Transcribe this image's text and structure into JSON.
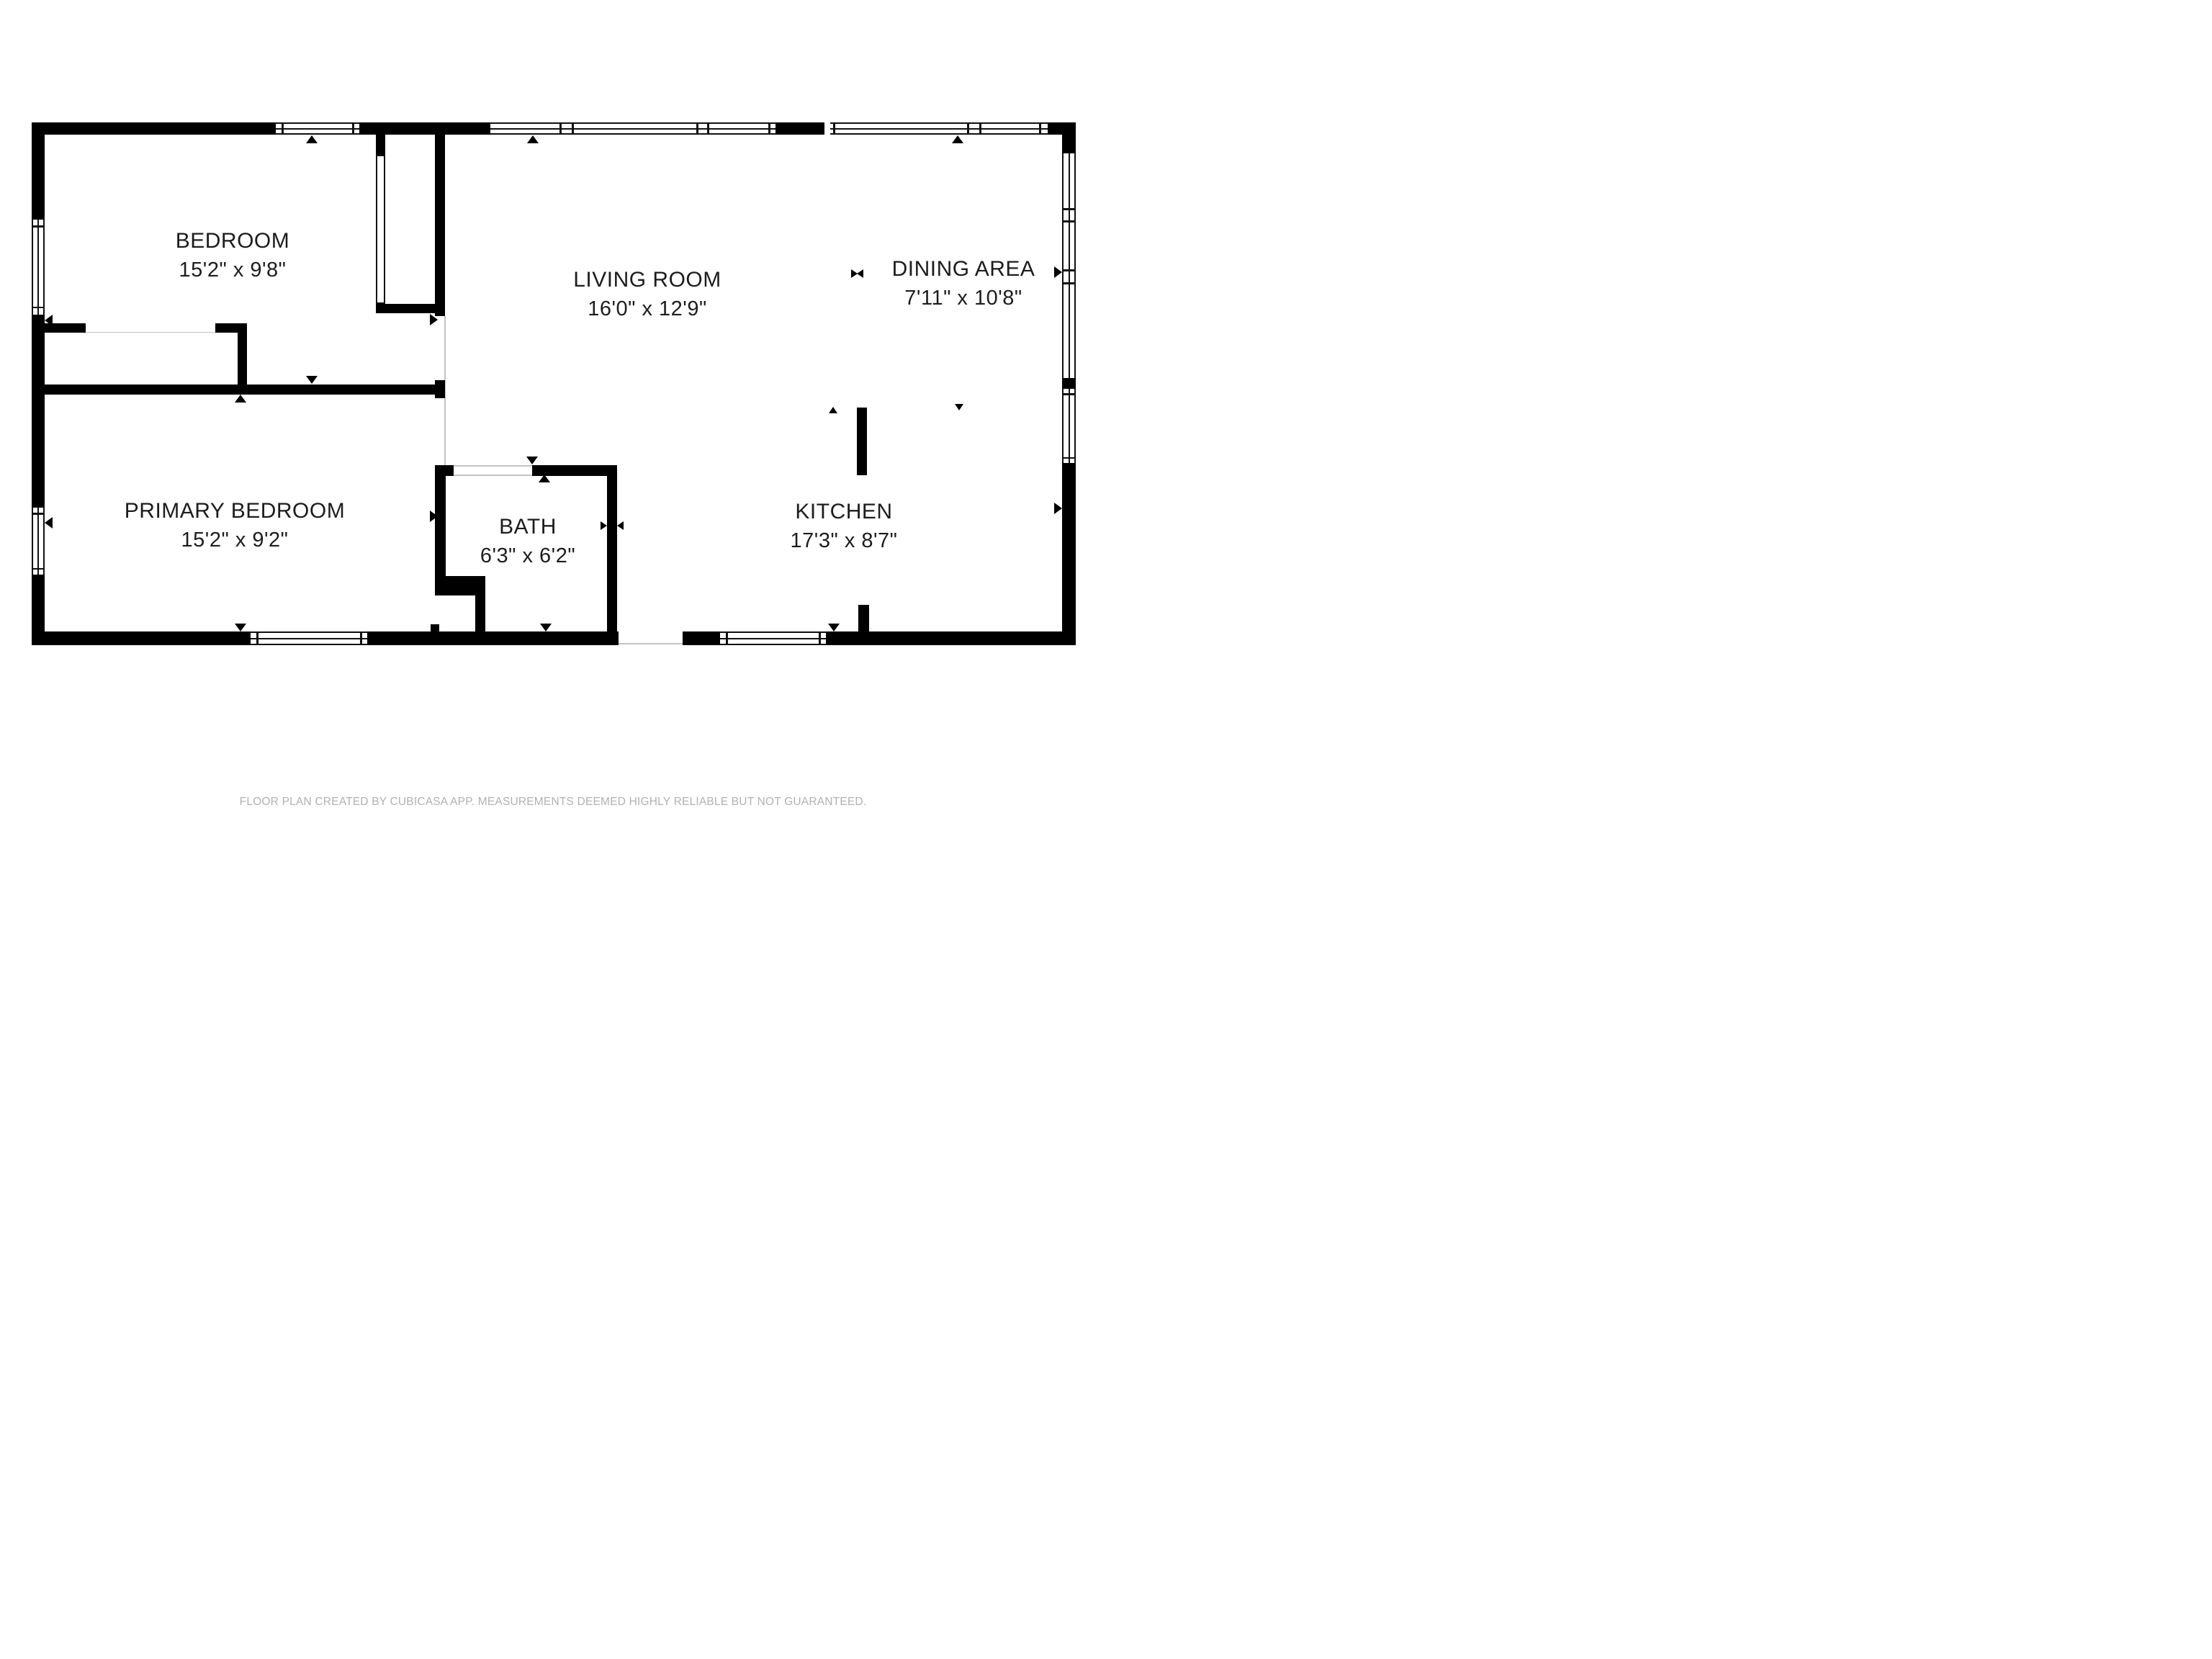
{
  "plan": {
    "creator_note": "FLOOR PLAN CREATED BY CUBICASA APP. MEASUREMENTS DEEMED HIGHLY RELIABLE BUT NOT GUARANTEED.",
    "rooms": [
      {
        "name": "BEDROOM",
        "dims": "15'2\" x 9'8\""
      },
      {
        "name": "LIVING ROOM",
        "dims": "16'0\" x 12'9\""
      },
      {
        "name": "DINING AREA",
        "dims": "7'11\" x 10'8\""
      },
      {
        "name": "PRIMARY BEDROOM",
        "dims": "15'2\" x 9'2\""
      },
      {
        "name": "BATH",
        "dims": "6'3\" x 6'2\""
      },
      {
        "name": "KITCHEN",
        "dims": "17'3\" x 8'7\""
      }
    ],
    "colors": {
      "wall": "#000000",
      "window_frame": "#111111",
      "open_boundary_line": "#c4c4c4",
      "label_text": "#1d1d1d",
      "footer_text": "#b1b1b1",
      "background": "#ffffff"
    }
  }
}
